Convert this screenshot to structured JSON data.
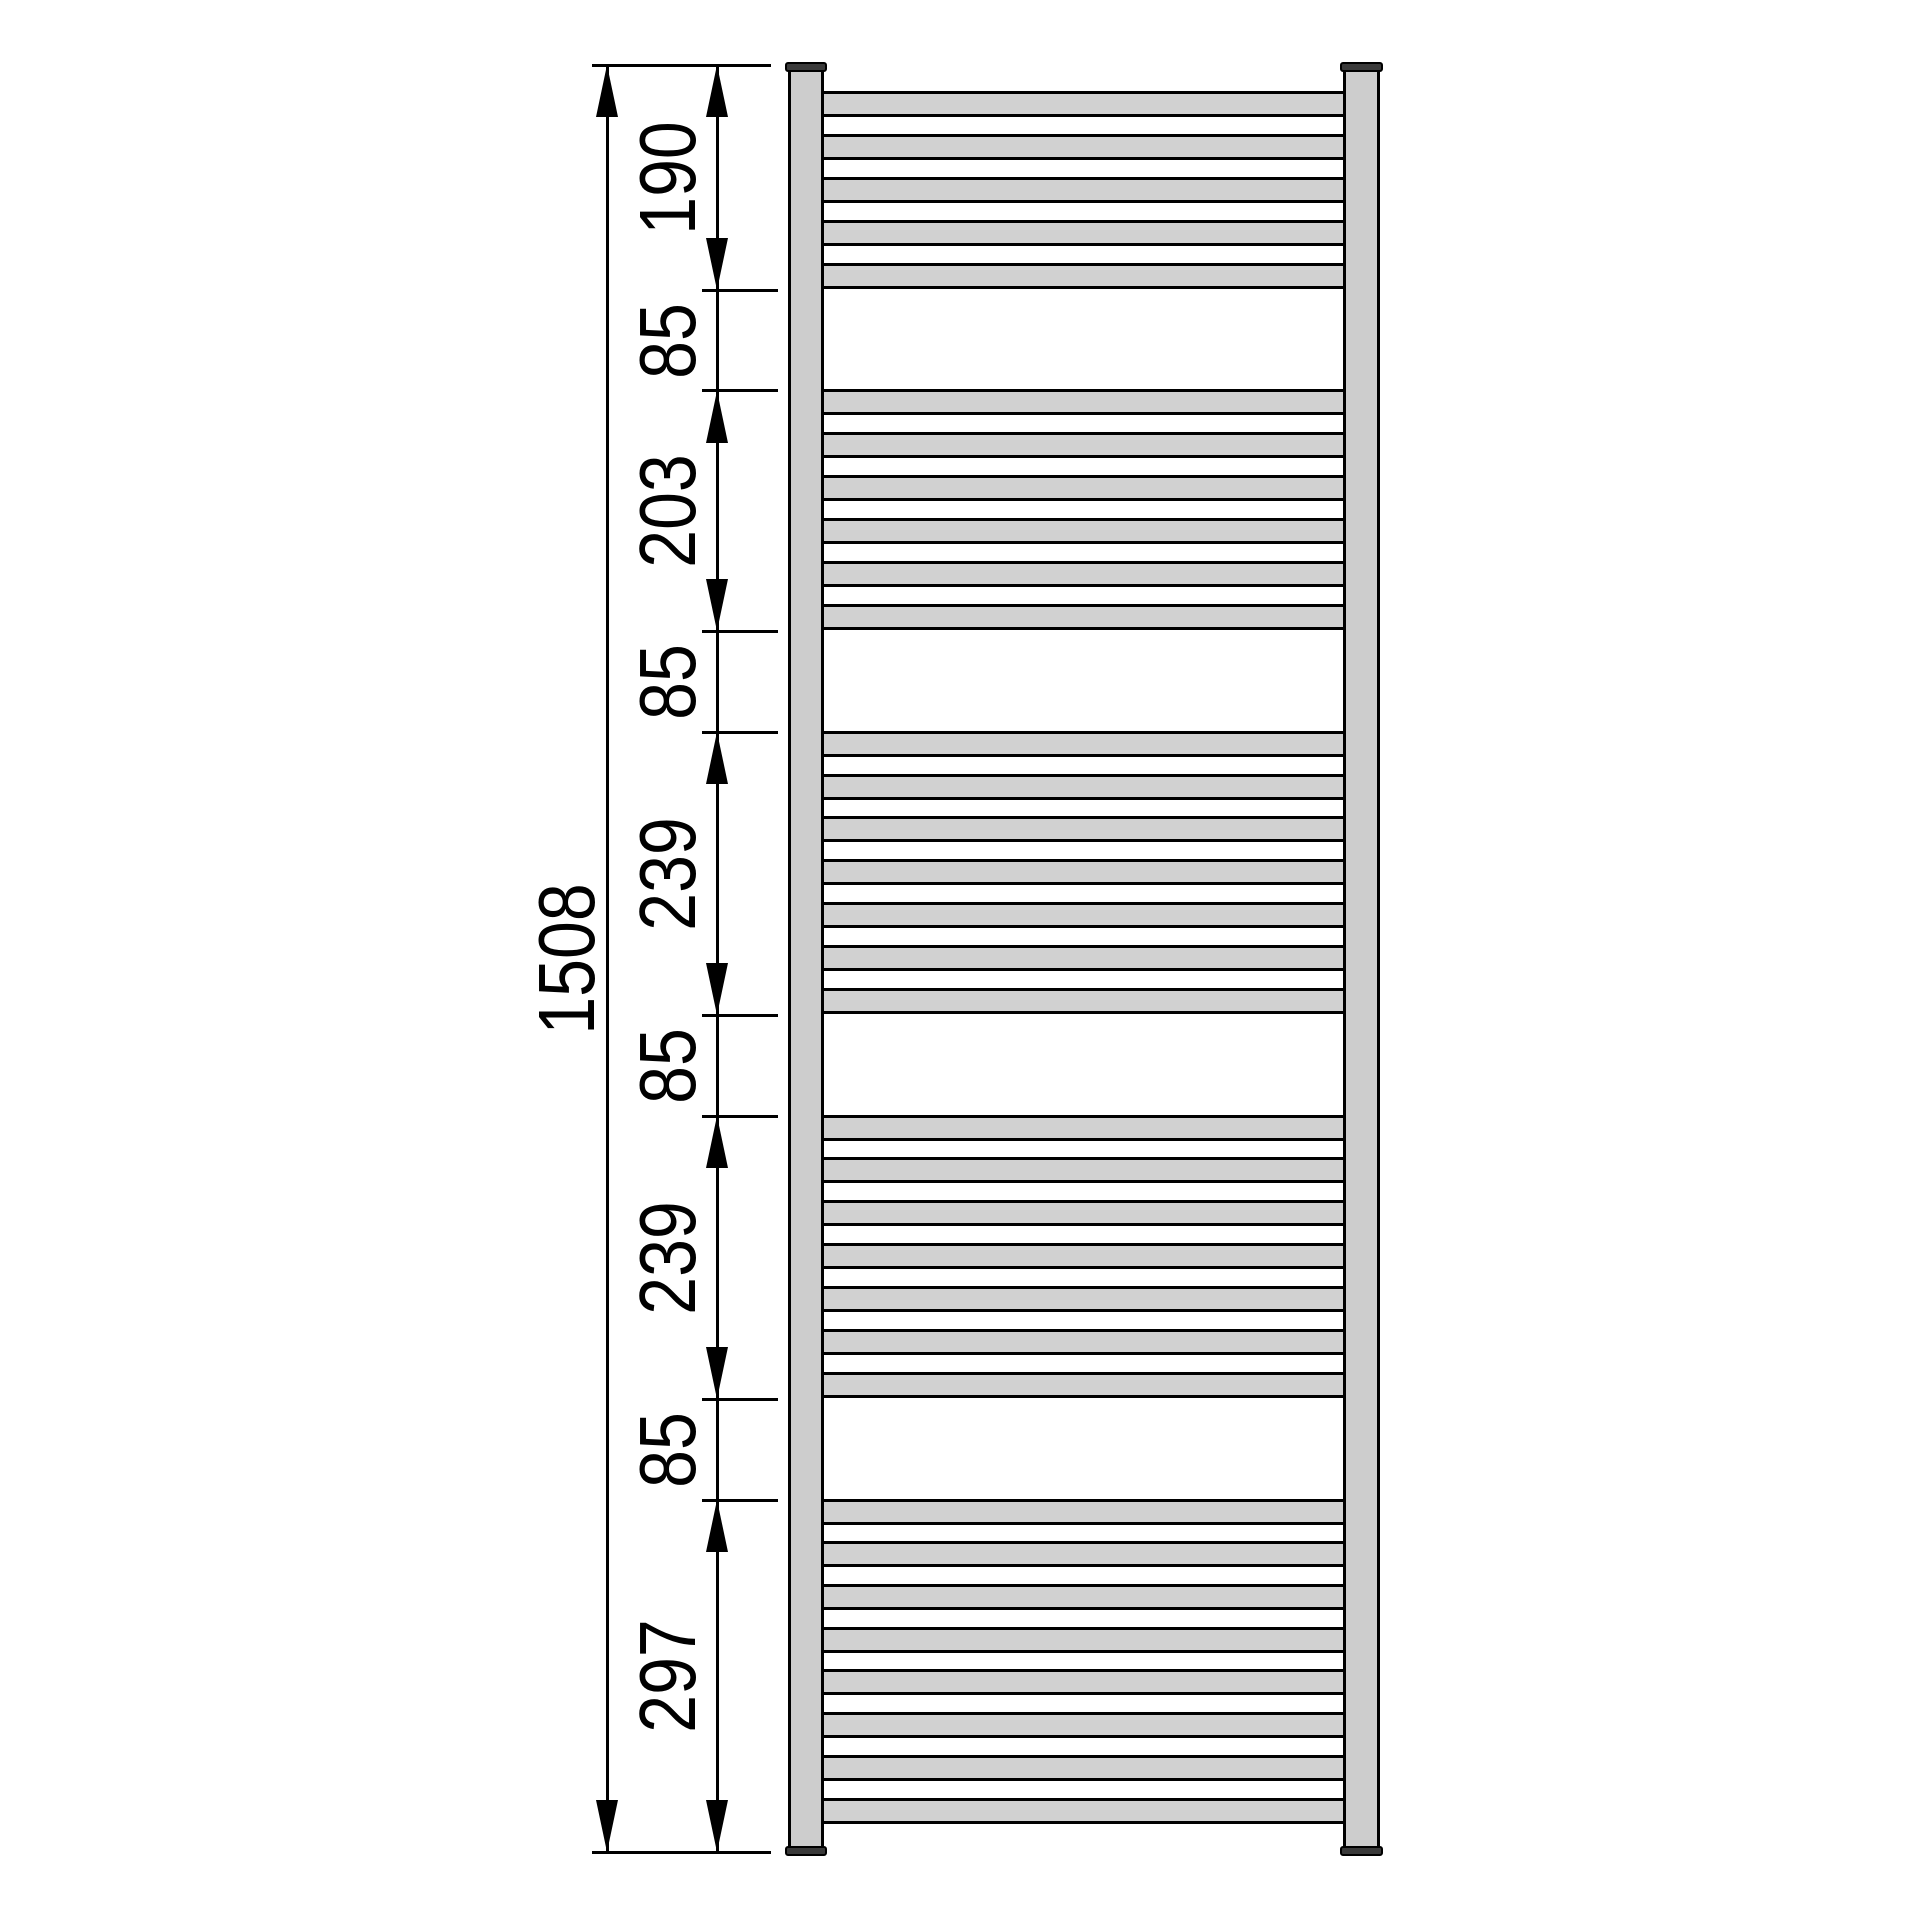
{
  "drawing": {
    "type": "technical-dimension-drawing",
    "subject": "ladder towel radiator, front view",
    "background": "#ffffff",
    "line_color": "#000000",
    "tube_fill": "#d1d1d1",
    "rail_fill": "#cdcdcd",
    "cap_fill": "#3a3a3a"
  },
  "overall_dimension": {
    "label": "1508",
    "value_mm": 1508
  },
  "segment_dimensions": [
    {
      "label": "190",
      "value_mm": 190,
      "has_arrows": true
    },
    {
      "label": "85",
      "value_mm": 85,
      "has_arrows": false
    },
    {
      "label": "203",
      "value_mm": 203,
      "has_arrows": true
    },
    {
      "label": "85",
      "value_mm": 85,
      "has_arrows": false
    },
    {
      "label": "239",
      "value_mm": 239,
      "has_arrows": true
    },
    {
      "label": "85",
      "value_mm": 85,
      "has_arrows": false
    },
    {
      "label": "239",
      "value_mm": 239,
      "has_arrows": true
    },
    {
      "label": "85",
      "value_mm": 85,
      "has_arrows": false
    },
    {
      "label": "297",
      "value_mm": 297,
      "has_arrows": true
    }
  ],
  "radiator": {
    "rail_count": 2,
    "rung_groups": [
      {
        "rungs": 5,
        "segment_index": 0
      },
      {
        "rungs": 6,
        "segment_index": 2
      },
      {
        "rungs": 7,
        "segment_index": 4
      },
      {
        "rungs": 7,
        "segment_index": 6
      },
      {
        "rungs": 8,
        "segment_index": 8
      }
    ]
  }
}
